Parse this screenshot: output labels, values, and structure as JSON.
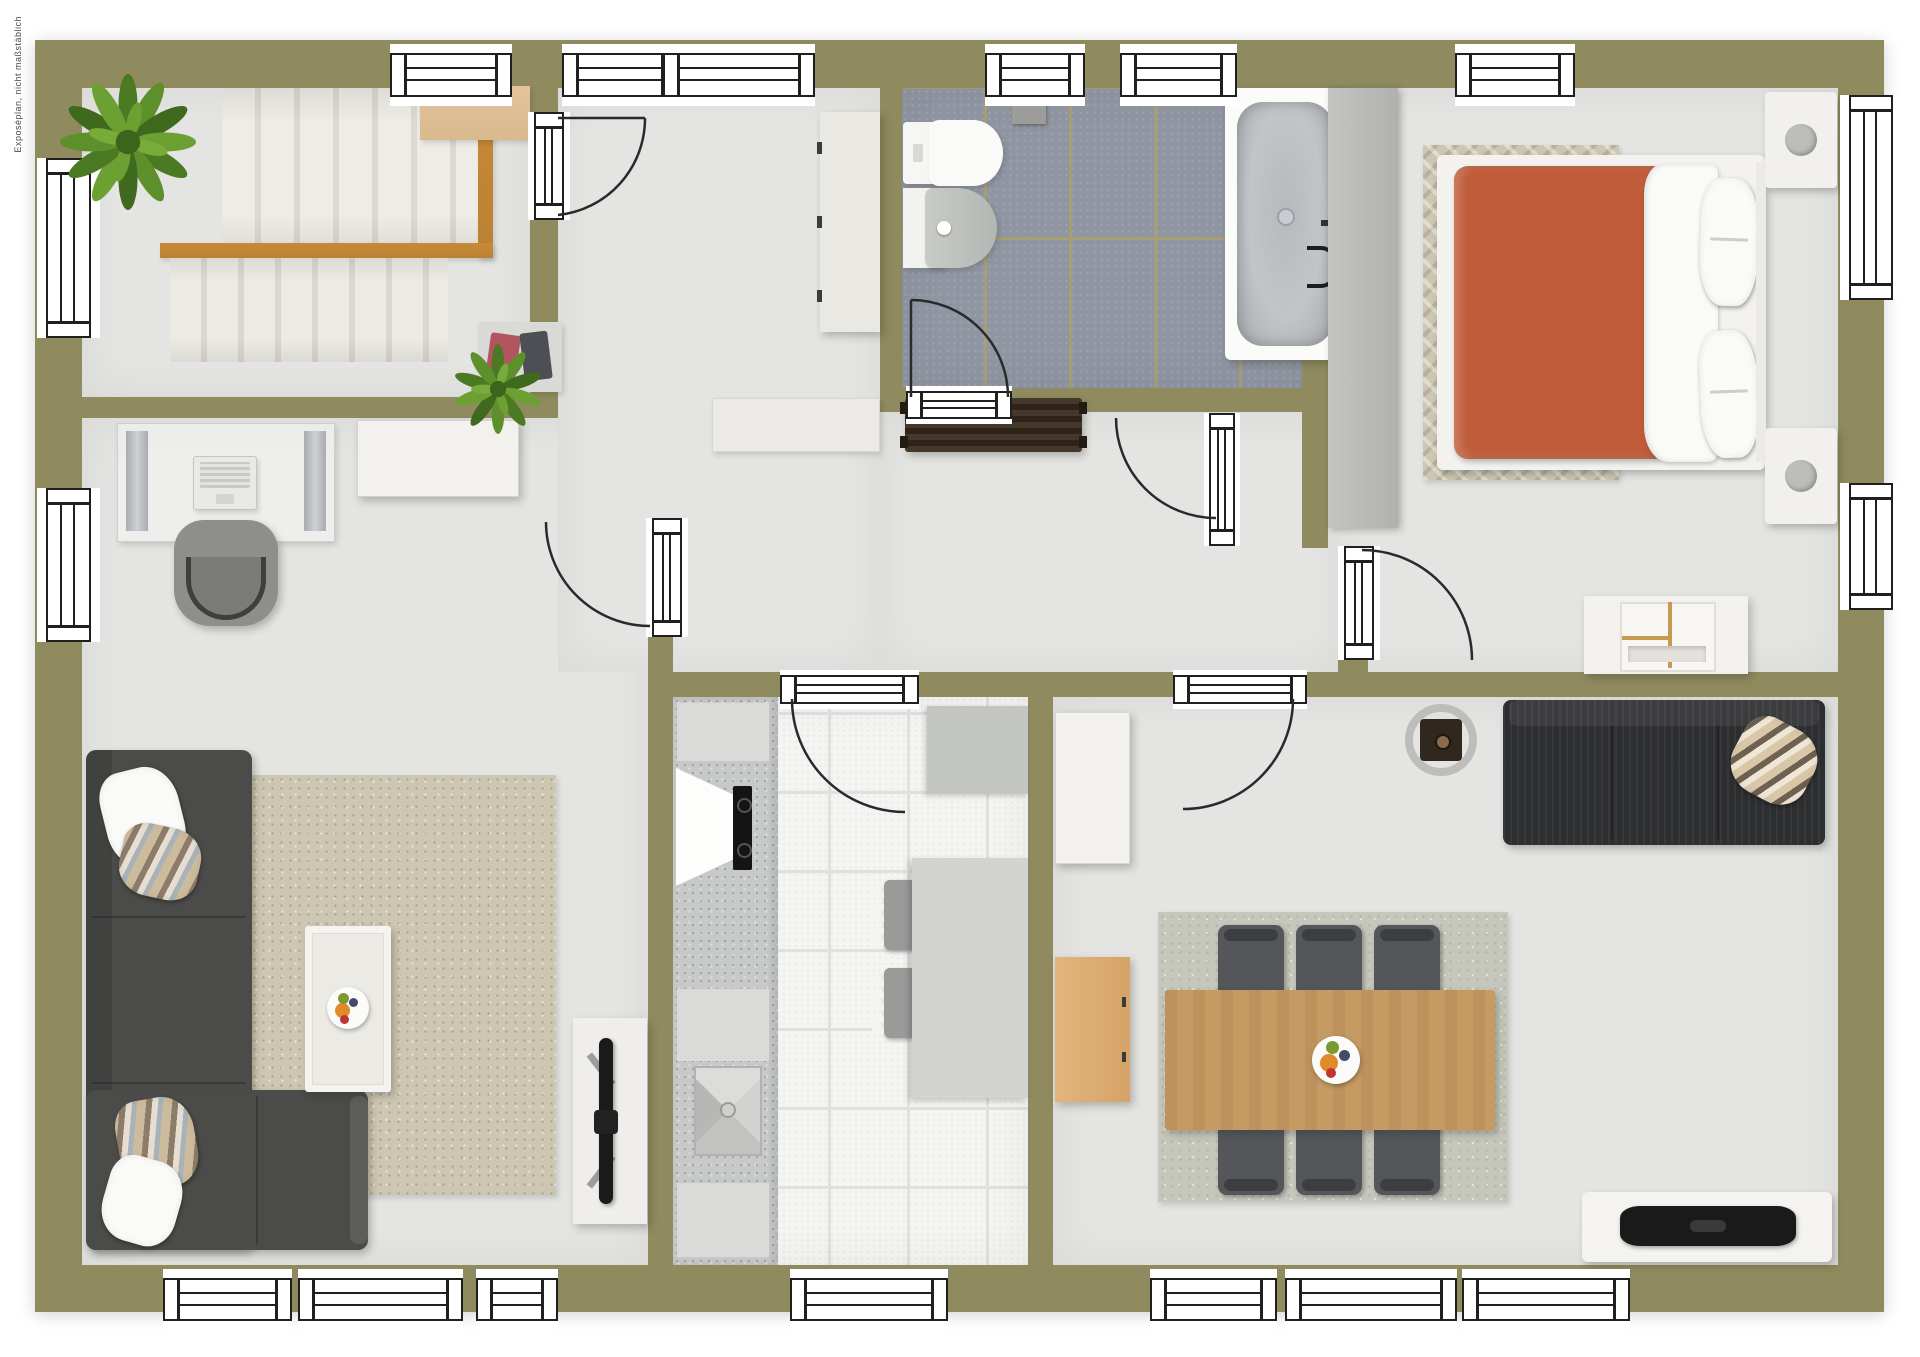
{
  "watermark": {
    "text": "Exposéplan, nicht maßstäblich"
  },
  "rooms": [
    "staircase-room",
    "home-office",
    "living-room",
    "hallway",
    "bathroom",
    "bedroom",
    "kitchen",
    "dining-room"
  ],
  "palette": {
    "wall": "#8f8b5e",
    "floor": "#e4e4e2",
    "bathTile": "#8f95a1",
    "bathGrout": "#a89e74",
    "kitchenTile": "#f4f4f2",
    "kitchenGrout": "#e0e1df",
    "counter": "#c6c9c8",
    "counterLight": "#dadbd9",
    "white": "#f2f1ee",
    "woodRail": "#bb8133",
    "woodShelf": "#d9b98e",
    "woodTable": "#c59a63",
    "woodCabinet": "#d5a368",
    "terracotta": "#c05c39",
    "bedRug": "#ccc6b3",
    "sofaGray": "#4b4b49",
    "sofaBlack": "#2d2e30",
    "livingRug": "#cdc6b2",
    "diningRug": "#c6c7bc",
    "chairDark": "#54565a",
    "benchBrown": "#3a2b1e",
    "plantDark": "#3f6a1d",
    "plantMid": "#527d26",
    "plantLight": "#6da033",
    "tvBlack": "#1a1a1a",
    "lampGray": "#bdbdbb",
    "wardrobe": "#bcbdbb",
    "applianceGray": "#c3c5c3",
    "glassLine": "#1f1f1f",
    "arc": "#2a2a2a"
  }
}
